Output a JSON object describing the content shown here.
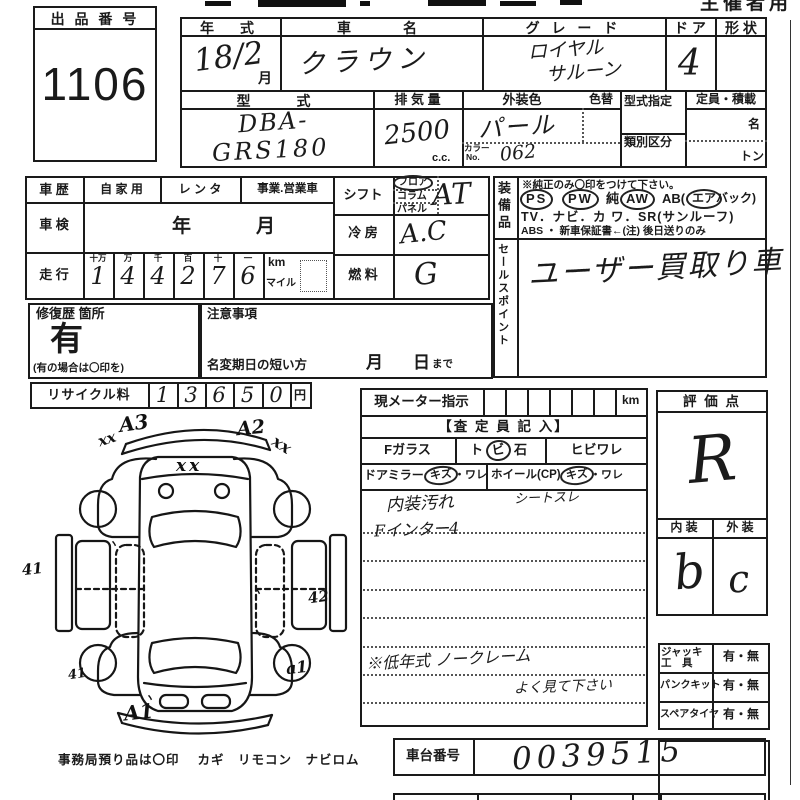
{
  "header": {
    "organizer": "主催者用"
  },
  "lot": {
    "title": "出 品 番 号",
    "number": "1106"
  },
  "top": {
    "year_label": "年　式",
    "year_value": "18/2",
    "month": "月",
    "name_label": "車　　名",
    "name_value": "クラウン",
    "grade_label": "グ レ ー ド",
    "grade1": "ロイヤル",
    "grade2": "サルーン",
    "door_label": "ド ア",
    "door_value": "4",
    "shape_label": "形 状",
    "model_label": "型　　式",
    "model1": "DBA-",
    "model2": "GRS180",
    "disp_label": "排 気 量",
    "disp_value": "2500",
    "disp_unit": "c.c.",
    "color_label": "外装色",
    "color_alt_label": "色替",
    "color_value": "パール",
    "color_no_label1": "カラー",
    "color_no_label2": "No.",
    "color_no": "062",
    "katashiki_label": "型式指定",
    "ruibetsu_label": "類別区分",
    "capacity_label": "定員・積載",
    "cap_unit1": "名",
    "cap_unit2": "トン"
  },
  "history": {
    "label": "車 歴",
    "opt1": "自 家 用",
    "opt2": "レ ン タ",
    "opt3": "事業.営業車",
    "shaken_label": "車 検",
    "year": "年",
    "month": "月",
    "soukou_label": "走 行",
    "dh": [
      "十万",
      "万",
      "千",
      "百",
      "十",
      "一"
    ],
    "digits": [
      "1",
      "4",
      "4",
      "2",
      "7",
      "6"
    ],
    "km": "km",
    "mile": "マイル"
  },
  "drive": {
    "shift_label": "シフト",
    "floor": "フロア",
    "column": "コラム",
    "panel": "パネル",
    "shift_value": "AT",
    "ac_label": "冷 房",
    "ac_value": "A.C",
    "fuel_label": "燃 料",
    "fuel_value": "G"
  },
  "equip": {
    "label": "装備品",
    "note": "※純正のみ〇印をつけて下さい。",
    "ps": "PS",
    "pw": "PW",
    "jun": "純",
    "aw": "AW",
    "ab": "AB(",
    "air": "エア",
    "bag": "バック)",
    "line2": "TV．ナビ．カ ワ．SR(サンルーフ)",
    "line3": "ABS ・ 新車保証書←(注) 後日送りのみ"
  },
  "sales": {
    "label": "セールスポイント",
    "value": "ユーザー買取り車"
  },
  "repair": {
    "label": "修復歴 箇所",
    "value": "有",
    "note": "(有の場合は〇印を)"
  },
  "caution": {
    "label": "注意事項",
    "namechange": "名変期日の短い方",
    "month": "月",
    "day": "日",
    "made": "まで"
  },
  "recycle": {
    "label": "リサイクル料",
    "digits": [
      "1",
      "3",
      "6",
      "5",
      "0"
    ],
    "yen": "円"
  },
  "meter": {
    "label": "現メーター指示",
    "km": "km"
  },
  "assessor": {
    "title": "【査 定 員 記 入】",
    "fglass": "Fガラス",
    "to": "ト",
    "bi": "ビ",
    "ishi": "石",
    "hibiware": "ヒビワレ",
    "mirror": "ドアミラー",
    "kizu1": "キズ",
    "ware1": "・ワレ",
    "wheel": "ホイール(CP)",
    "kizu2": "キズ",
    "ware2": "・ワレ",
    "note1a": "内装汚れ",
    "note1b": "シートスレ",
    "note2": "Fインター4",
    "note3": "※低年式 ノークレーム",
    "note4": "よく見て下さい"
  },
  "rating": {
    "label": "評 価 点",
    "value": "R",
    "int_label": "内 装",
    "ext_label": "外 装",
    "int_value": "b",
    "ext_value": "c"
  },
  "tools": {
    "jack1": "ジャッキ",
    "jack2": "工　具",
    "jack_v": "有・無",
    "punk": "パンクキット",
    "punk_v": "有・無",
    "spare": "スペアタイヤ",
    "spare_v": "有・無"
  },
  "chassis": {
    "label": "車台番号",
    "value": "0039515"
  },
  "footer": {
    "text": "事務局預り品は〇印　 カギ　リモコン　ナビロム"
  },
  "diagram": {
    "marks": [
      {
        "t": "xx"
      },
      {
        "t": "A3"
      },
      {
        "t": "A2"
      },
      {
        "t": "xx"
      },
      {
        "t": "xx"
      },
      {
        "t": "41"
      },
      {
        "t": "42"
      },
      {
        "t": "41"
      },
      {
        "t": "a1"
      },
      {
        "t": "A1"
      },
      {
        "t": "ヽ"
      },
      {
        "t": "ヽ"
      },
      {
        "t": "ヽ"
      }
    ]
  }
}
